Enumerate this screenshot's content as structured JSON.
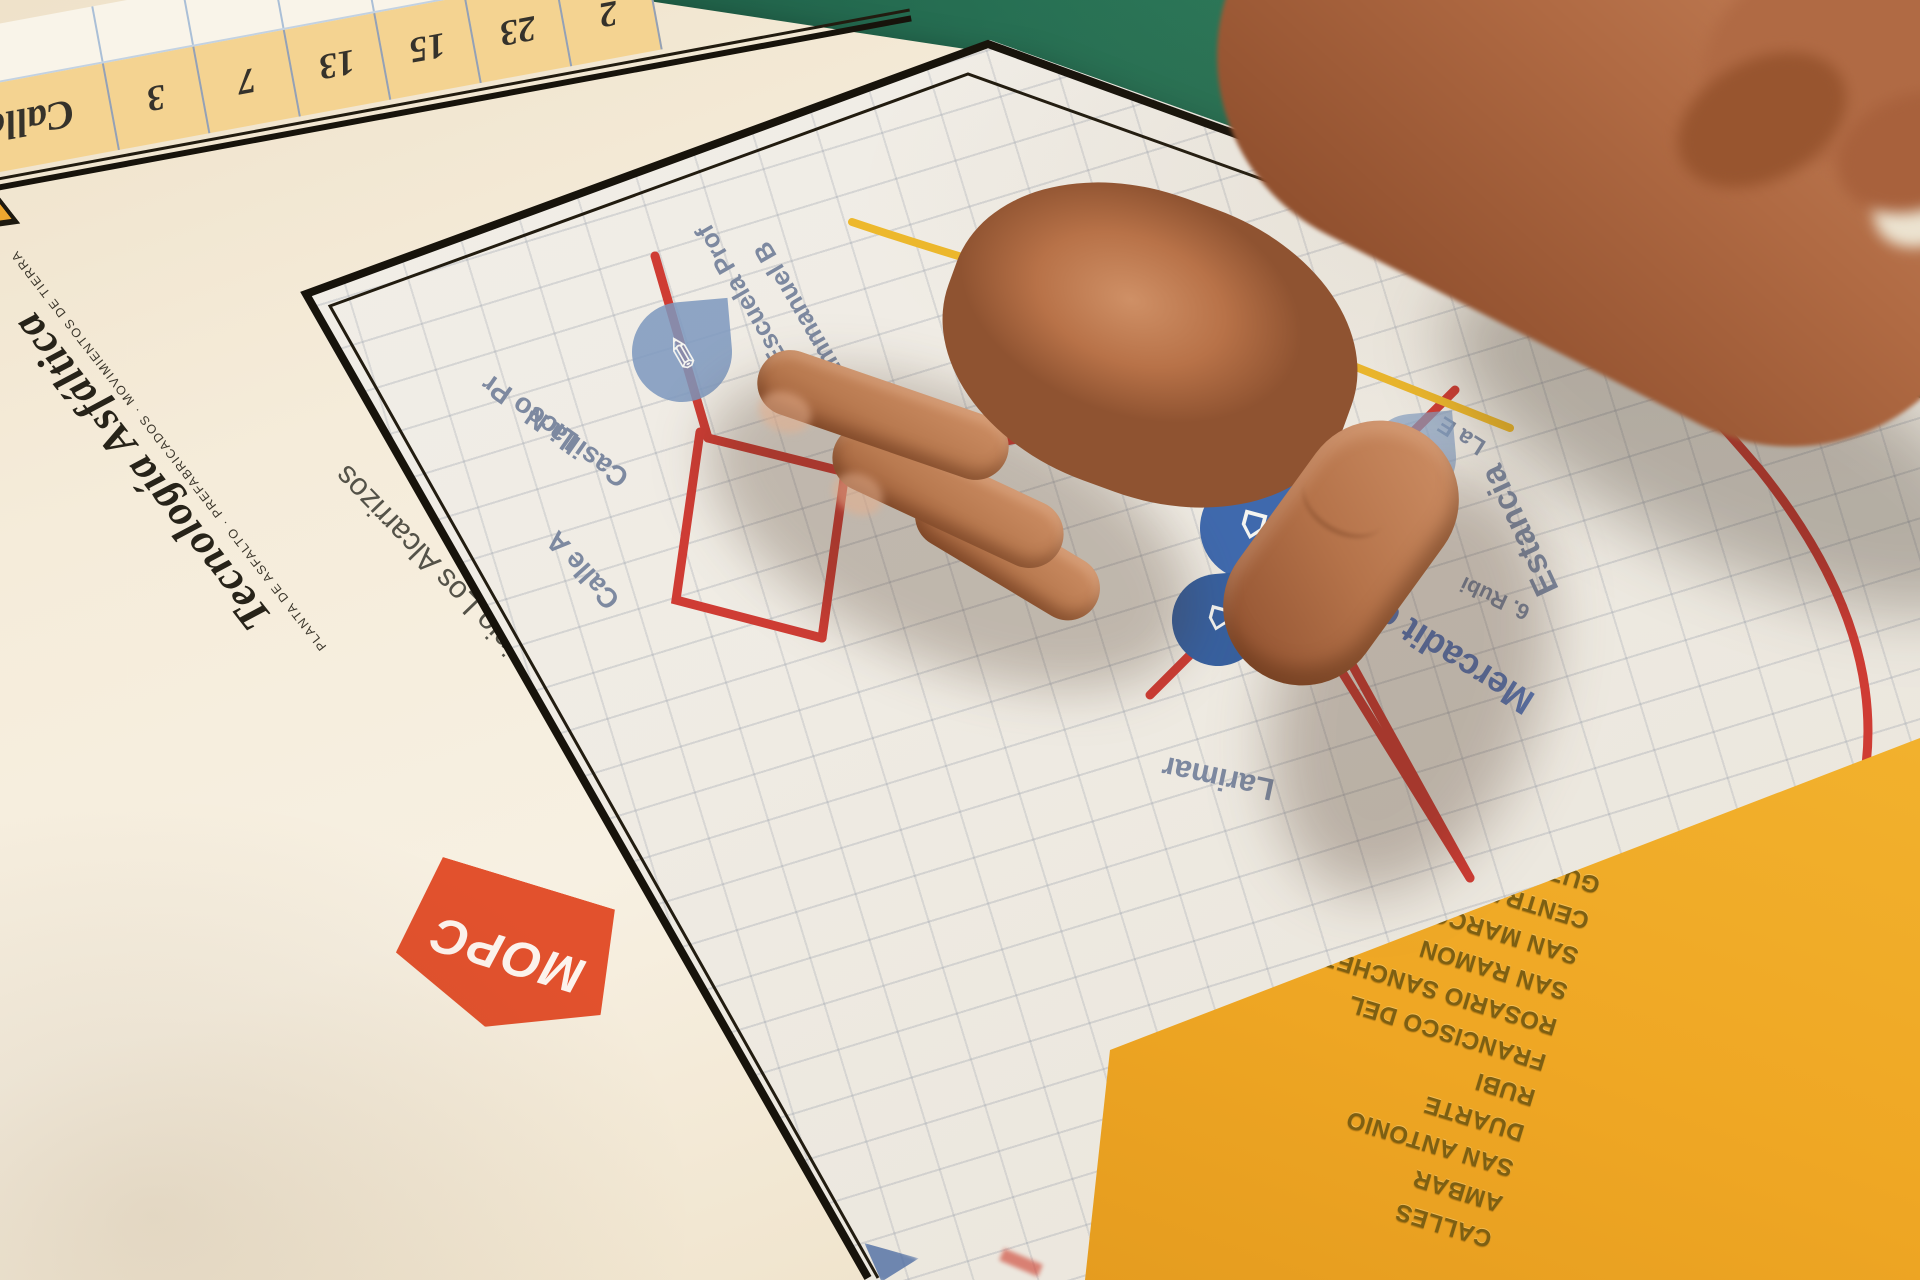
{
  "colors": {
    "table_green": "#23684e",
    "paper_cream": "#f5ecda",
    "legend_yellow": "#efa724",
    "road_red": "#cf3c34",
    "road_yellow": "#edb82c",
    "pin_blue": "#3f69ad",
    "mopc_orange": "#e2512d",
    "ta_yellow": "#efa72f"
  },
  "table_strip": {
    "header": "Calles",
    "values": [
      "3",
      "7",
      "13",
      "15",
      "23",
      "2"
    ]
  },
  "brand": {
    "tecnologia_name": "Tecnología Asfáltica",
    "tecnologia_tagline": "PLANTA DE ASFALTO · PREFABRICADOS · MOVIMIENTOS DE TIERRA",
    "tecnologia_monogram": "TA",
    "mopc": "MOPC"
  },
  "poster_title": "de Asfalto y Recapeo en el Sector Los Cocos, Municipio Los Alcarrizos",
  "map": {
    "labels": {
      "liceo": "Liceo Pr",
      "casilla": "Casilla N",
      "escuela": "Escuela Prof",
      "emmanuel": "Emmanuel B",
      "calle_a": "Calle A",
      "larimar": "Larimar",
      "mercado": "Mercadit de leon",
      "estancia": "Estancia",
      "rubi": "6. Rubi",
      "la_e": "La E"
    },
    "pins": {
      "school": "✎",
      "market": "⌂",
      "store": "⌂",
      "poi": "⌂"
    },
    "legend": {
      "header": "CALLES",
      "streets": [
        "AMBAR",
        "SAN ANTONIO",
        "DUARTE",
        "RUBI",
        "FRANCISCO DEL",
        "ROSARIO SANCHEZ",
        "SAN RAMON",
        "SAN MARCOS",
        "CENTRAL",
        "GUZMAN",
        "SAN LUCAS"
      ]
    }
  }
}
